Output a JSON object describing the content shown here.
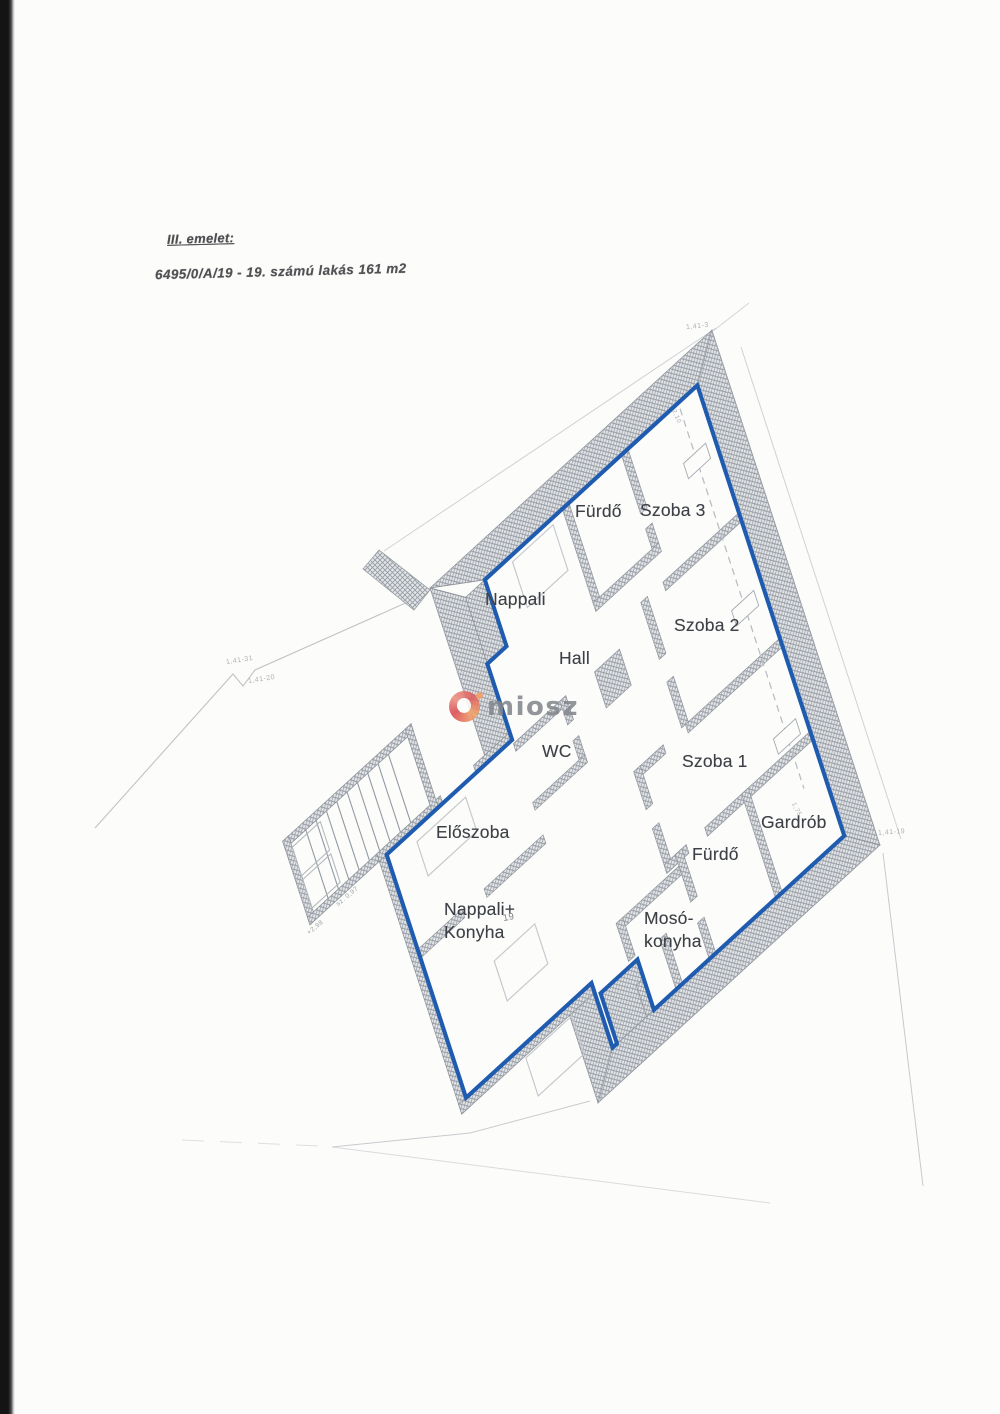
{
  "header": {
    "floor_label": "III. emelet:",
    "unit_label": "6495/0/A/19 - 19. számú lakás 161 m2"
  },
  "watermark": {
    "brand": "miosz"
  },
  "plan": {
    "rooms": [
      {
        "id": "nappali",
        "label": "Nappali"
      },
      {
        "id": "furdo_top",
        "label": "Fürdő"
      },
      {
        "id": "szoba3",
        "label": "Szoba 3"
      },
      {
        "id": "szoba2",
        "label": "Szoba 2"
      },
      {
        "id": "hall",
        "label": "Hall"
      },
      {
        "id": "wc",
        "label": "WC"
      },
      {
        "id": "szoba1",
        "label": "Szoba 1"
      },
      {
        "id": "gardrob",
        "label": "Gardrób"
      },
      {
        "id": "eloszoba",
        "label": "Előszoba"
      },
      {
        "id": "furdo_bottom",
        "label": "Fürdő"
      },
      {
        "id": "nappali_konyha",
        "label": "Nappali+\nKonyha"
      },
      {
        "id": "moso_konyha",
        "label": "Mosó-\nkonyha"
      }
    ],
    "annotations": {
      "parcel_top": "1,41-3",
      "parcel_left_upper": "1,41-31",
      "parcel_left_lower": "1,41-20",
      "parcel_right": "1,41-19",
      "unit_number": "19",
      "stair_note": "sz. 0,97",
      "level_note": "+2,98",
      "door_dim_gardrob": "1,75",
      "door_dim_hall": "2,10"
    },
    "colors": {
      "boundary_blue": "#1f5cb0",
      "wall_gray": "#9299a2",
      "label_text": "#3d4046"
    }
  }
}
